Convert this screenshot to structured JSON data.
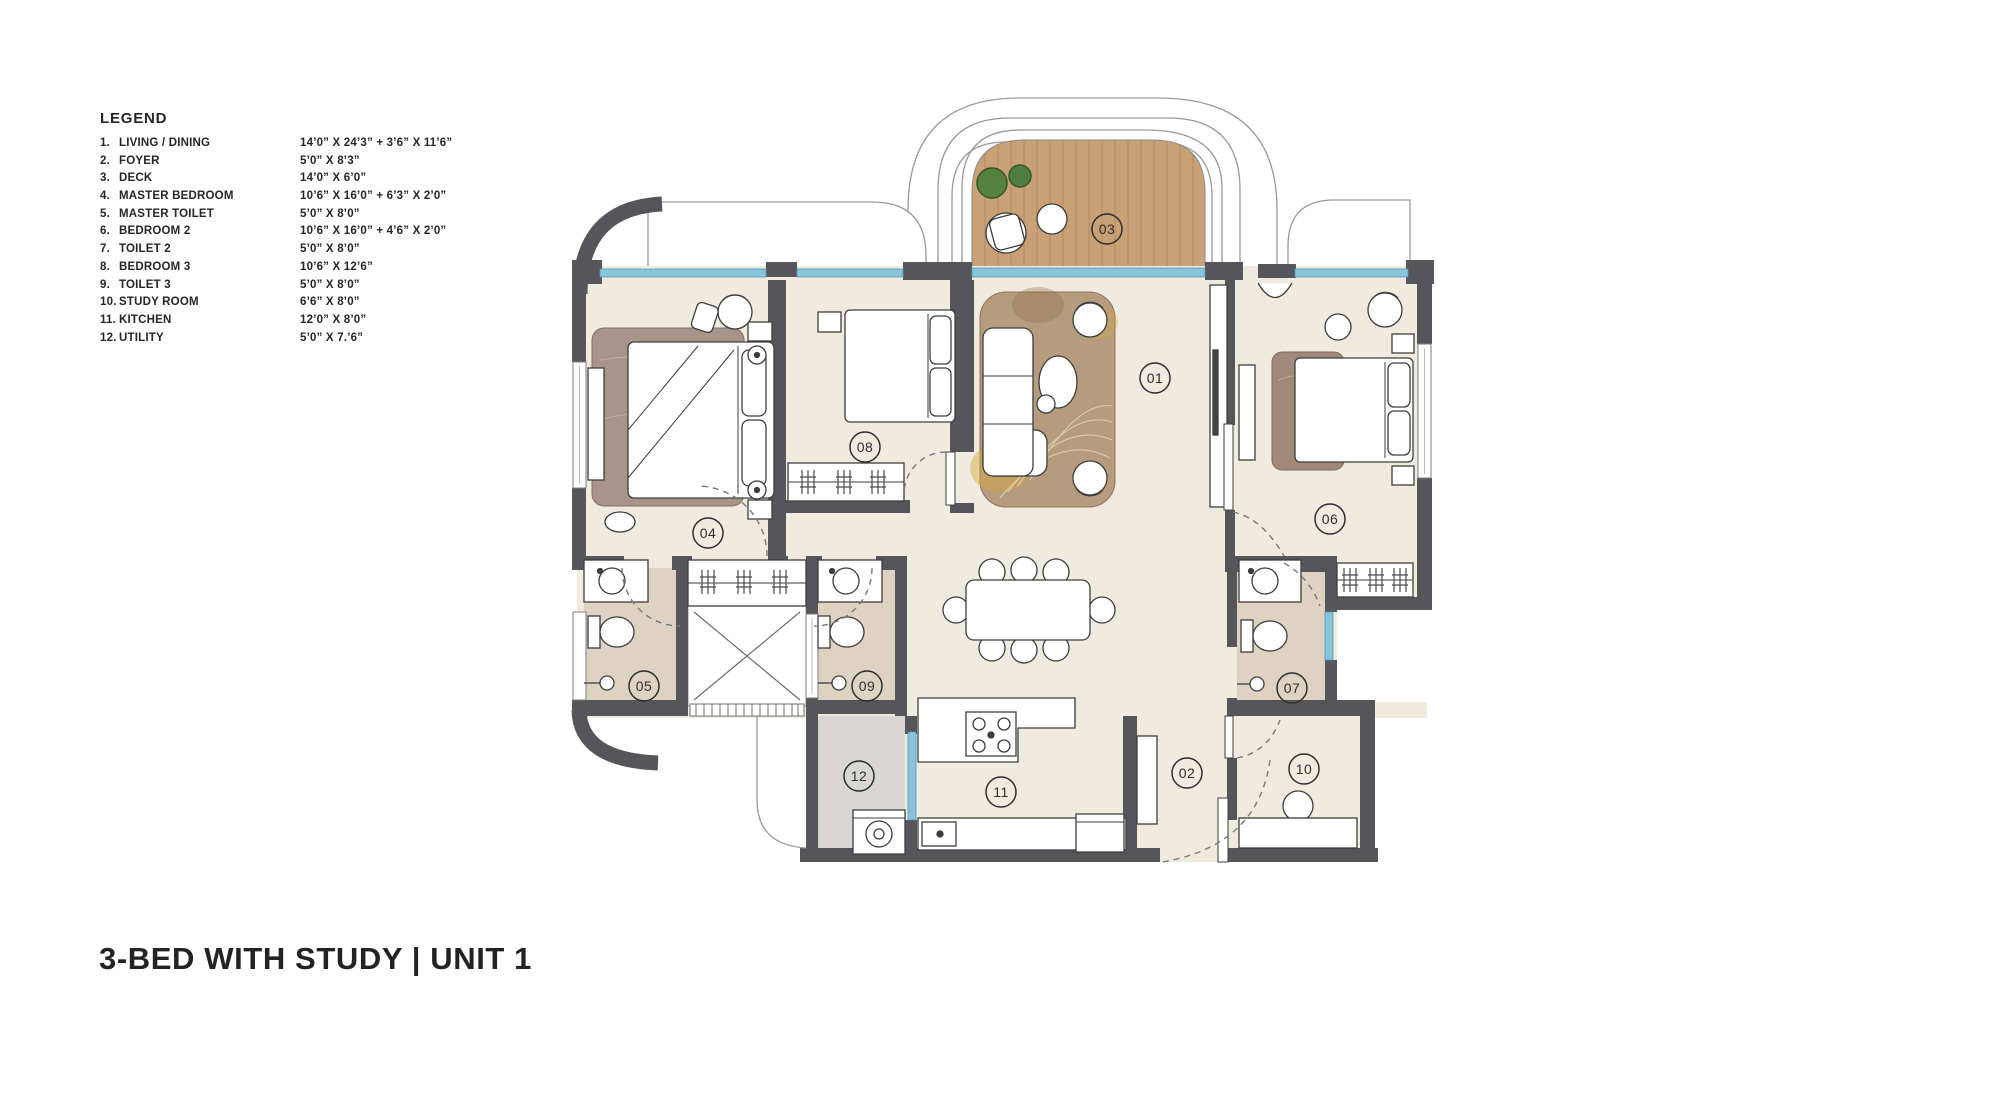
{
  "page": {
    "title": "3-BED WITH STUDY | UNIT 1"
  },
  "legend": {
    "heading": "LEGEND",
    "items": [
      {
        "num": "1.",
        "name": "LIVING / DINING",
        "dim": "14’0” X 24’3” + 3’6” X 11’6”"
      },
      {
        "num": "2.",
        "name": "FOYER",
        "dim": "5’0” X 8’3”"
      },
      {
        "num": "3.",
        "name": "DECK",
        "dim": "14’0” X 6’0”"
      },
      {
        "num": "4.",
        "name": "MASTER BEDROOM",
        "dim": "10’6” X 16’0” + 6’3” X 2’0”"
      },
      {
        "num": "5.",
        "name": "MASTER TOILET",
        "dim": "5’0” X 8’0”"
      },
      {
        "num": "6.",
        "name": "BEDROOM 2",
        "dim": "10’6” X 16’0” + 4’6” X 2’0”"
      },
      {
        "num": "7.",
        "name": "TOILET 2",
        "dim": "5’0” X 8’0”"
      },
      {
        "num": "8.",
        "name": "BEDROOM 3",
        "dim": "10’6” X 12’6”"
      },
      {
        "num": "9.",
        "name": "TOILET 3",
        "dim": "5’0” X 8’0”"
      },
      {
        "num": "10.",
        "name": "STUDY ROOM",
        "dim": "6’6” X 8’0”"
      },
      {
        "num": "11.",
        "name": "KITCHEN",
        "dim": "12’0” X 8’0”"
      },
      {
        "num": "12.",
        "name": "UTILITY",
        "dim": "5’0” X 7.’6”"
      }
    ]
  },
  "plan": {
    "room_labels": [
      {
        "id": "01",
        "x": 1155,
        "y": 378
      },
      {
        "id": "02",
        "x": 1187,
        "y": 773
      },
      {
        "id": "03",
        "x": 1107,
        "y": 229
      },
      {
        "id": "04",
        "x": 708,
        "y": 533
      },
      {
        "id": "05",
        "x": 644,
        "y": 686
      },
      {
        "id": "06",
        "x": 1330,
        "y": 519
      },
      {
        "id": "07",
        "x": 1292,
        "y": 688
      },
      {
        "id": "08",
        "x": 865,
        "y": 447
      },
      {
        "id": "09",
        "x": 867,
        "y": 686
      },
      {
        "id": "10",
        "x": 1304,
        "y": 769
      },
      {
        "id": "11",
        "x": 1001,
        "y": 792
      },
      {
        "id": "12",
        "x": 859,
        "y": 776
      }
    ],
    "colors": {
      "wall": "#56565a",
      "floor_cream": "#f1ebdf",
      "floor_toilet": "#ded2c3",
      "floor_utility": "#d8d7d3",
      "deck_wood": "#c9a176",
      "glass_blue": "#8ac4d8",
      "rug_living": "#b59c7e",
      "rug_master": "#a8948a",
      "rug_bedroom2": "#a1887a",
      "plant_green": "#55803f",
      "outline": "#3d3d3d"
    }
  }
}
